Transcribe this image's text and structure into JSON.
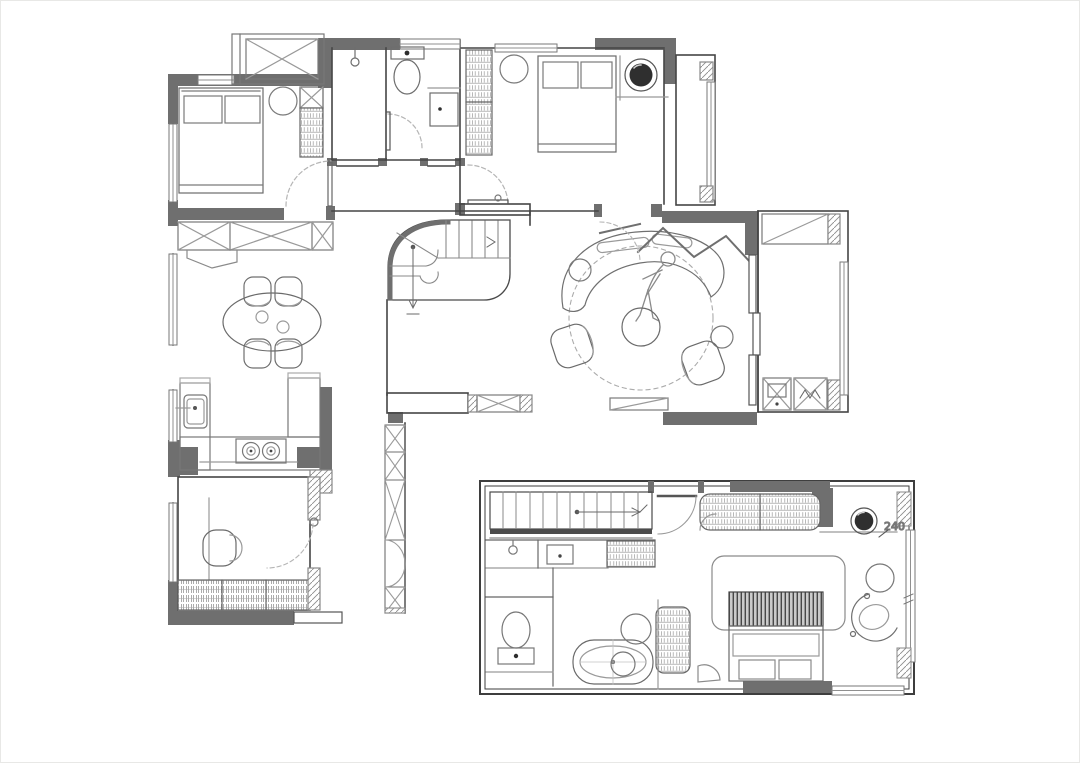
{
  "meta": {
    "title": "Two-storey apartment floor plan",
    "drawing_type": "architectural line drawing",
    "floors": [
      "main floor",
      "upper loft floor"
    ]
  },
  "canvas": {
    "width": 1080,
    "height": 763,
    "background": "#ffffff"
  },
  "colors": {
    "wall_fill": "#6f6f6f",
    "outline": "#454545",
    "furniture_line": "#7a7a7a",
    "light_line": "#9c9c9c",
    "dashed_line": "#ababab",
    "dark_accent": "#2e2e2e",
    "hatch": "#909090"
  },
  "labels": {
    "dimension_240": "240"
  },
  "main_floor": {
    "rooms": [
      {
        "name": "bedroom-left",
        "furniture": [
          "double-bed",
          "pillows",
          "bedside-round-table",
          "wardrobe",
          "storage-closet-x"
        ]
      },
      {
        "name": "bathroom",
        "furniture": [
          "shower-head",
          "toilet",
          "washbasin",
          "swing-door"
        ]
      },
      {
        "name": "bedroom-right",
        "furniture": [
          "wardrobe-shelf-column",
          "round-side-table",
          "double-bed",
          "dark-bedside-lamp",
          "swing-door",
          "balcony-window"
        ]
      },
      {
        "name": "dining-room",
        "furniture": [
          "wall-cabinet-row-x",
          "oval-dining-table",
          "four-dining-chairs"
        ]
      },
      {
        "name": "staircase",
        "furniture": [
          "curved-quarter-turn-stair",
          "direction-arrow"
        ]
      },
      {
        "name": "living-room",
        "furniture": [
          "curved-sofa",
          "reclining-person-figure",
          "round-coffee-table",
          "round-rug-dashed",
          "armchair-left",
          "armchair-right",
          "side-table",
          "tv-cabinet",
          "entry-zigzag-screen",
          "entry-door-arc"
        ]
      },
      {
        "name": "balcony",
        "furniture": [
          "top-cabinet",
          "washing-machine",
          "dryer-unit",
          "window-wall"
        ]
      },
      {
        "name": "kitchen",
        "furniture": [
          "sink",
          "two-burner-cooktop",
          "u-shaped-counter",
          "tall-pantry"
        ]
      },
      {
        "name": "study",
        "furniture": [
          "lounge-chair",
          "desk-line",
          "bookshelf-row",
          "door-with-arc",
          "tall-cabinet-column"
        ]
      }
    ]
  },
  "upper_floor": {
    "rooms": [
      {
        "name": "staircase",
        "furniture": [
          "straight-stair",
          "direction-arrow",
          "entry-door-arc"
        ]
      },
      {
        "name": "bathroom",
        "furniture": [
          "shower-head",
          "washbasin",
          "storage-shelf",
          "toilet",
          "oval-bathtub",
          "round-stools"
        ]
      },
      {
        "name": "bedroom",
        "furniture": [
          "wardrobe-hatched",
          "dark-bedside-lamp",
          "headboard-panel",
          "striped-headboard-bed",
          "round-table",
          "swivel-chair",
          "corner-stool",
          "window-wall"
        ]
      }
    ],
    "dimension_label": "240"
  }
}
